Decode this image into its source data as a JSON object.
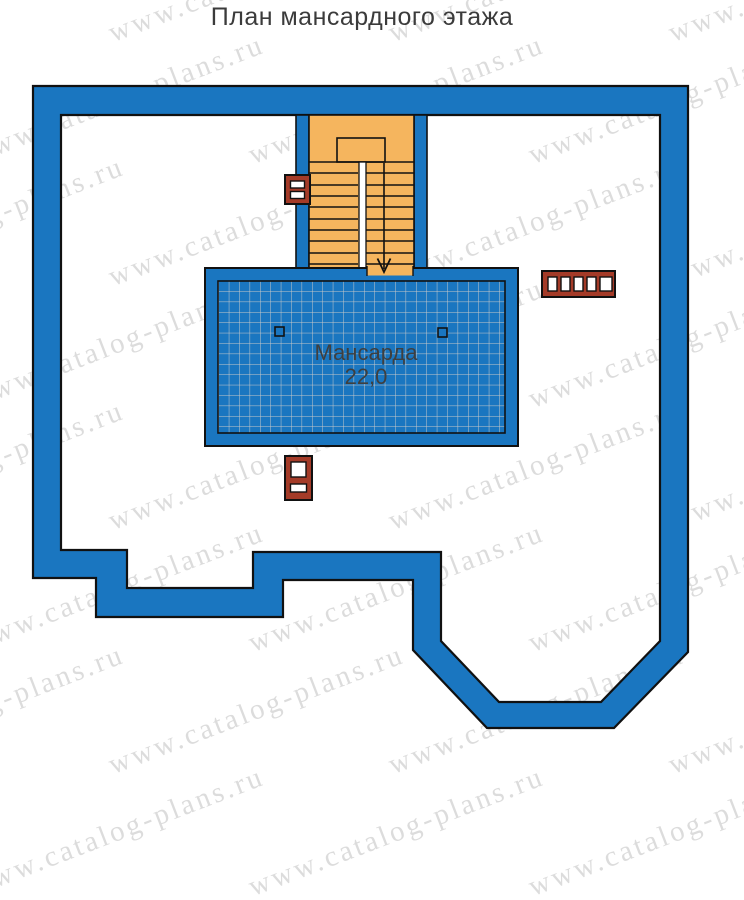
{
  "title": "План мансардного этажа",
  "watermark": {
    "text": "www.catalog-plans.ru"
  },
  "room": {
    "name": "Мансарда",
    "area": "22,0"
  },
  "colors": {
    "wall_blue": "#1a76c0",
    "stair_orange": "#f5b55e",
    "chimney_red": "#a43b28",
    "outline_black": "#111111",
    "grid_gray": "#c9c9c9",
    "watermark_gray": "#9b9b9b",
    "label_gray": "#3f3f3f"
  }
}
